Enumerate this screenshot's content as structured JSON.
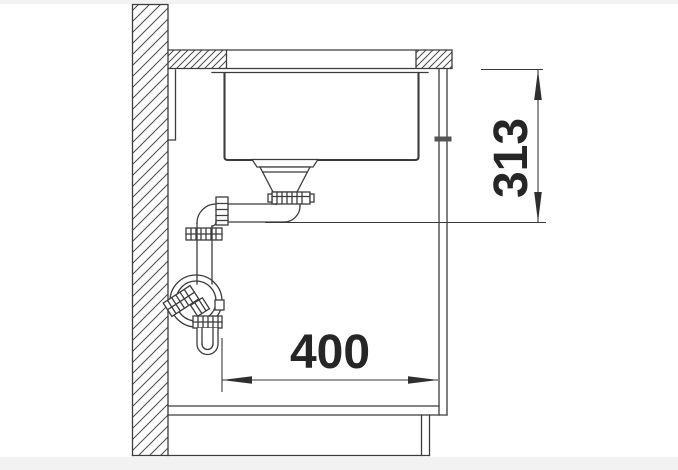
{
  "diagram": {
    "subject": "undermount-sink-side-section-installation-drawing",
    "dimensions": [
      {
        "value": "313",
        "orientation": "vertical"
      },
      {
        "value": "400",
        "orientation": "horizontal"
      }
    ],
    "colors": {
      "background": "#ffffff",
      "page_band": "#f2f2f2",
      "line": "#3c3c3c",
      "dimension_text": "#262626"
    }
  }
}
